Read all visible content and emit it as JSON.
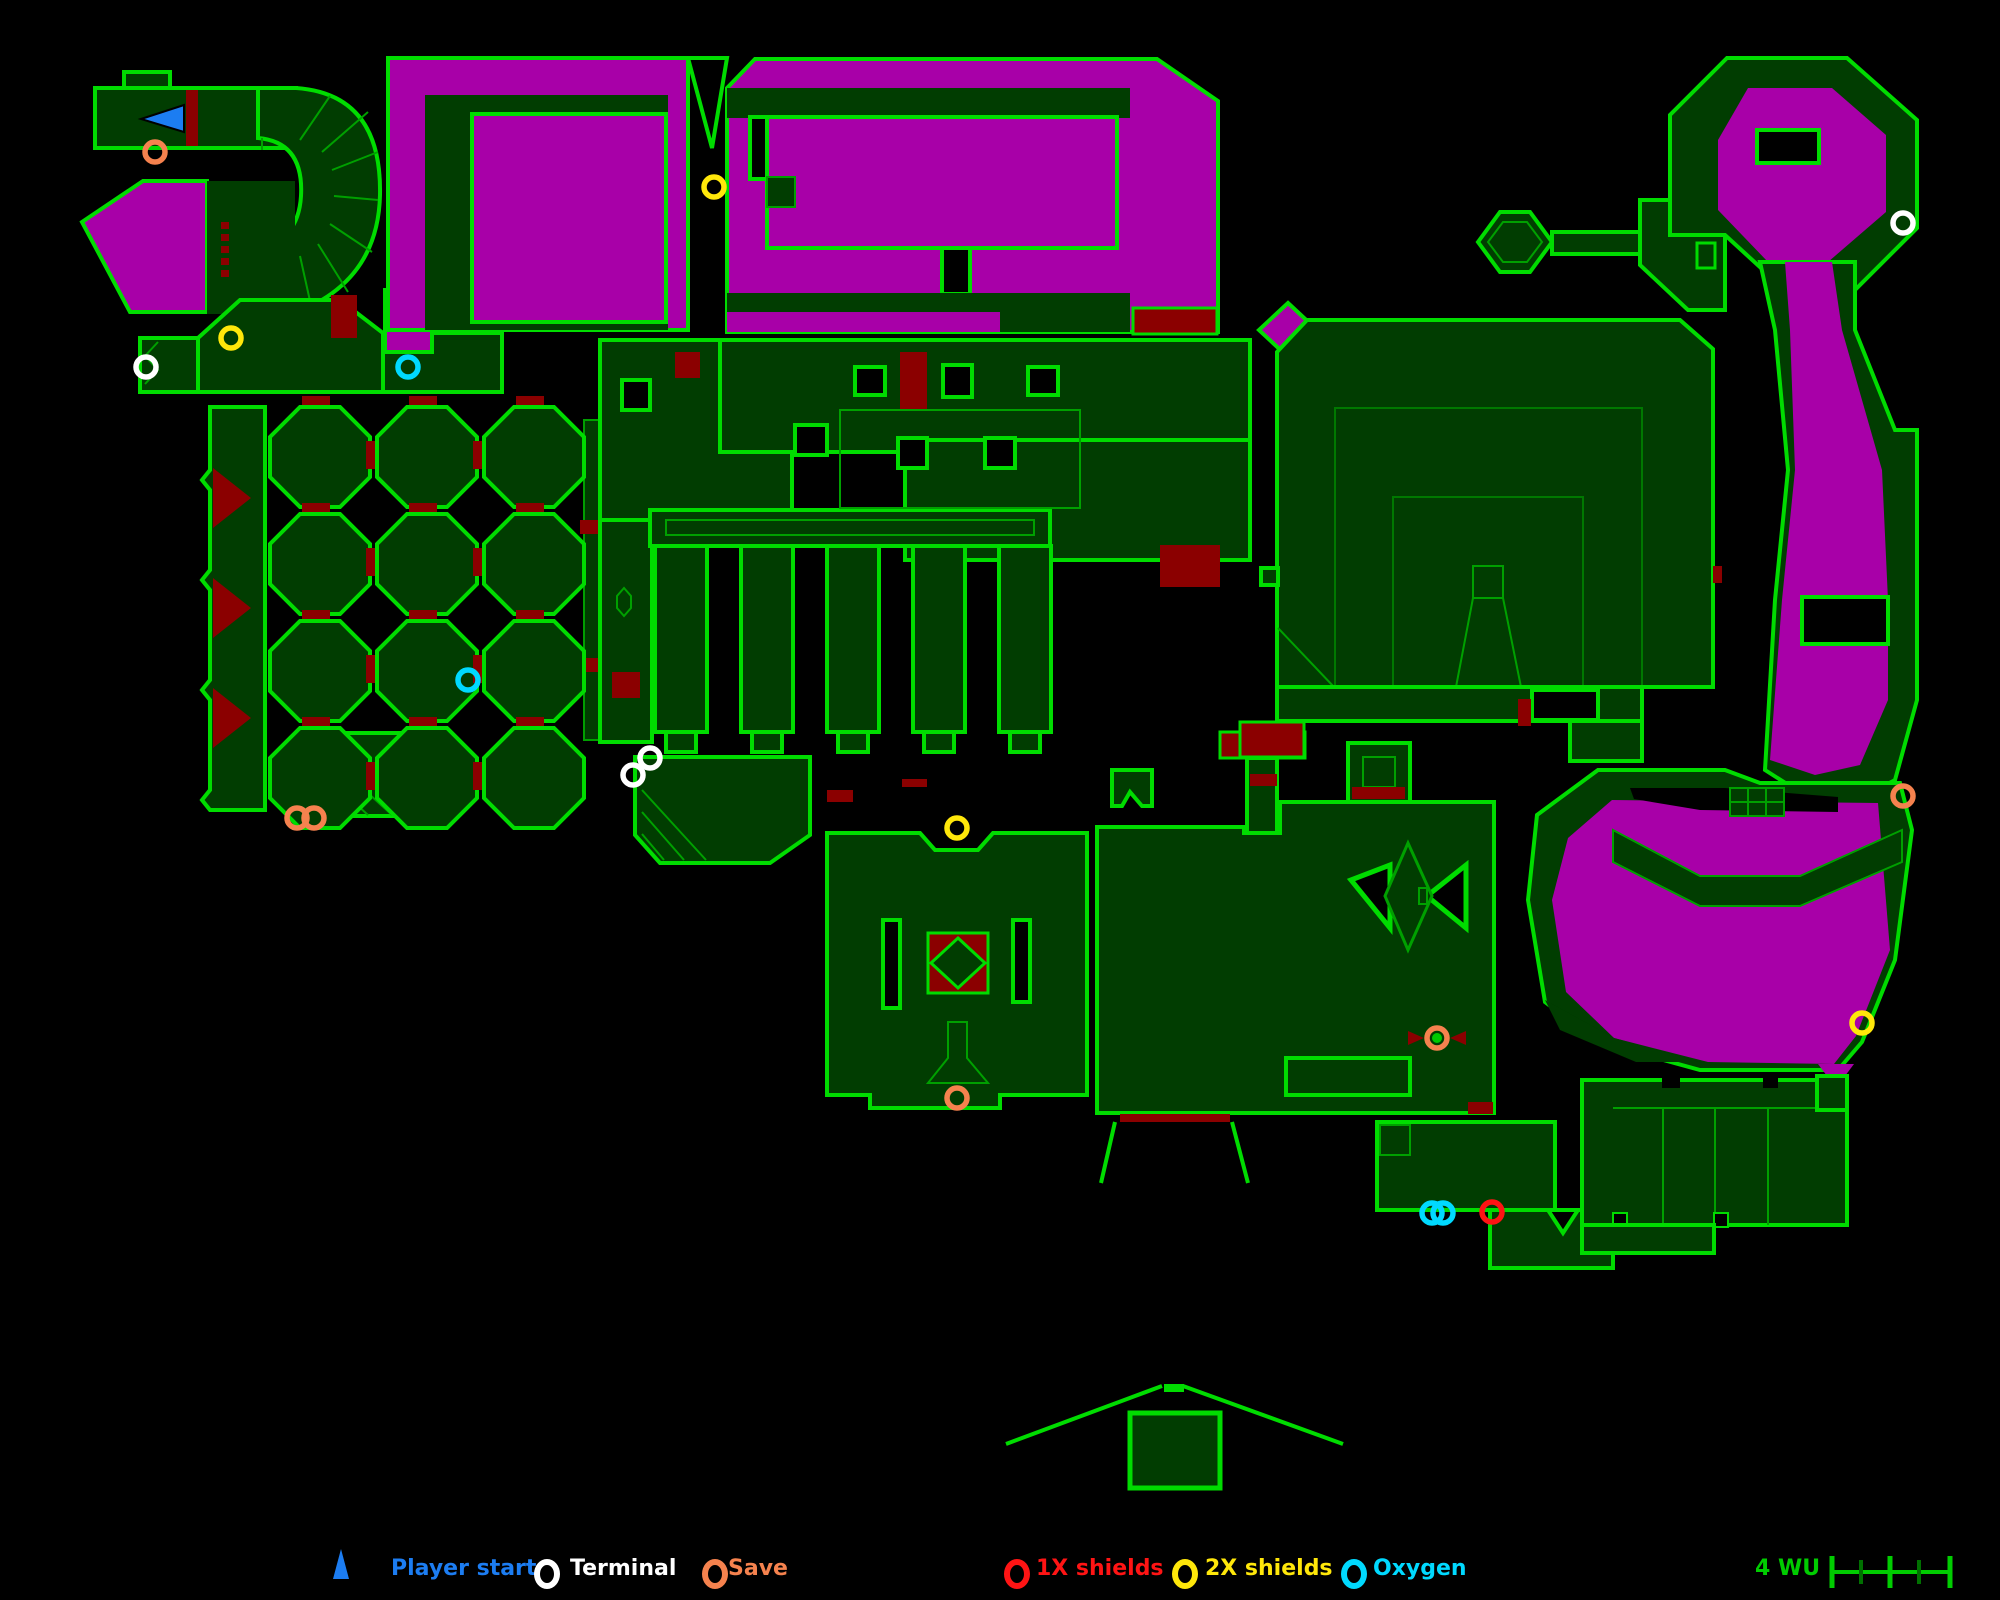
{
  "map": {
    "colors": {
      "wall": "#00DC00",
      "floor": "#013D01",
      "liquid": "#A800A8",
      "door": "#8B0000",
      "detail": "#00A000"
    },
    "marker_colors": {
      "player-start": "#1C7DF2",
      "terminal": "#FFFFFF",
      "save": "#F5824E",
      "1x-shields": "#FF1414",
      "2x-shields": "#FFE70A",
      "oxygen": "#00D9FF"
    },
    "markers": [
      {
        "type": "player-start",
        "x": 163,
        "y": 118
      },
      {
        "type": "save",
        "x": 155,
        "y": 152
      },
      {
        "type": "save",
        "x": 297,
        "y": 818
      },
      {
        "type": "save",
        "x": 314,
        "y": 818
      },
      {
        "type": "save",
        "x": 957,
        "y": 1098
      },
      {
        "type": "save",
        "x": 1437,
        "y": 1038,
        "dot": true
      },
      {
        "type": "save",
        "x": 1903,
        "y": 796
      },
      {
        "type": "terminal",
        "x": 146,
        "y": 367
      },
      {
        "type": "terminal",
        "x": 633,
        "y": 775
      },
      {
        "type": "terminal",
        "x": 650,
        "y": 758
      },
      {
        "type": "terminal",
        "x": 1903,
        "y": 223
      },
      {
        "type": "2x-shields",
        "x": 231,
        "y": 338
      },
      {
        "type": "2x-shields",
        "x": 714,
        "y": 187
      },
      {
        "type": "2x-shields",
        "x": 957,
        "y": 828
      },
      {
        "type": "2x-shields",
        "x": 1862,
        "y": 1023
      },
      {
        "type": "oxygen",
        "x": 408,
        "y": 367
      },
      {
        "type": "oxygen",
        "x": 468,
        "y": 680
      },
      {
        "type": "oxygen",
        "x": 1432,
        "y": 1213
      },
      {
        "type": "oxygen",
        "x": 1443,
        "y": 1213
      },
      {
        "type": "1x-shields",
        "x": 1492,
        "y": 1212
      }
    ],
    "octagon_grid": {
      "x0": 270,
      "y0": 407,
      "cols": 3,
      "rows": 4,
      "cell": 100,
      "pitch": 107,
      "chamfer": 30
    }
  },
  "legend": {
    "items": [
      {
        "id": "player-start",
        "label": "Player start",
        "color": "#1C7DF2",
        "icon": "triangle"
      },
      {
        "id": "terminal",
        "label": "Terminal",
        "color": "#FFFFFF",
        "icon": "circle"
      },
      {
        "id": "save",
        "label": "Save",
        "color": "#F5824E",
        "icon": "circle"
      },
      {
        "id": "1x-shields",
        "label": "1X shields",
        "color": "#FF1414",
        "icon": "circle"
      },
      {
        "id": "2x-shields",
        "label": "2X shields",
        "color": "#FFE70A",
        "icon": "circle"
      },
      {
        "id": "oxygen",
        "label": "Oxygen",
        "color": "#00D9FF",
        "icon": "circle"
      }
    ],
    "scale_label": "4 WU",
    "scale_color": "#00CC00"
  }
}
